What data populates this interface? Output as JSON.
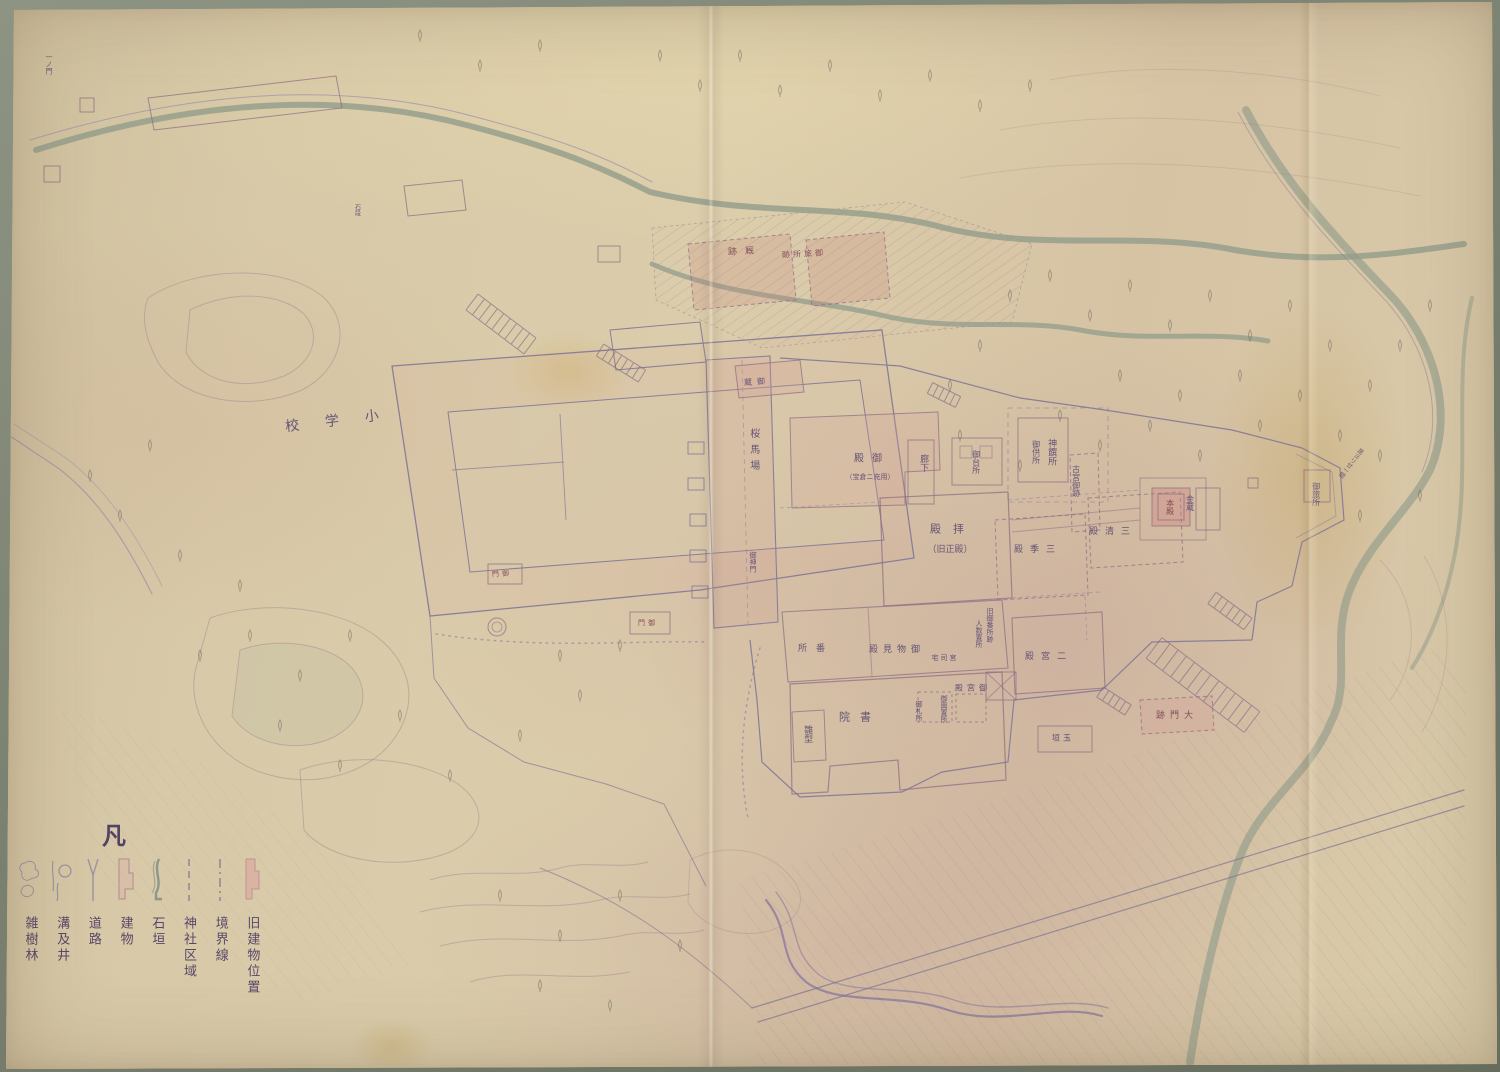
{
  "legend": {
    "title": "凡",
    "items": [
      {
        "label": "旧建物位置",
        "symbol": "old-building-position"
      },
      {
        "label": "境界線",
        "symbol": "boundary-line"
      },
      {
        "label": "神社区域",
        "symbol": "shrine-area"
      },
      {
        "label": "石垣",
        "symbol": "stone-wall"
      },
      {
        "label": "建物",
        "symbol": "building"
      },
      {
        "label": "道路",
        "symbol": "road"
      },
      {
        "label": "溝及井",
        "symbol": "ditch-and-well"
      },
      {
        "label": "雑樹林",
        "symbol": "mixed-forest"
      }
    ]
  },
  "map": {
    "labels": [
      {
        "id": "elementary-school",
        "text": "小学校",
        "x": 345,
        "y": 420,
        "o": "h",
        "size": 14,
        "ls": 26,
        "rot": -7,
        "rtl": true
      },
      {
        "id": "stable-site",
        "text": "厩跡",
        "x": 745,
        "y": 252,
        "o": "h",
        "size": 9,
        "ls": 8,
        "rot": -3,
        "rtl": true,
        "color": "#7a4152"
      },
      {
        "id": "otabisho-site",
        "text": "御旅所跡",
        "x": 804,
        "y": 254,
        "o": "h",
        "size": 8,
        "ls": 3,
        "rot": -3,
        "rtl": true,
        "color": "#7a4152"
      },
      {
        "id": "sakura-baba",
        "text": "桜馬場",
        "x": 753,
        "y": 452,
        "o": "v",
        "size": 10,
        "ls": 6
      },
      {
        "id": "shinmon-note",
        "text": "御神門",
        "x": 753,
        "y": 562,
        "o": "v",
        "size": 7
      },
      {
        "id": "goten",
        "text": "御殿",
        "x": 872,
        "y": 459,
        "o": "h",
        "size": 10,
        "ls": 8,
        "rtl": true
      },
      {
        "id": "goten-sub",
        "text": "（宝倉ニ充用）",
        "x": 870,
        "y": 477,
        "o": "h",
        "size": 7
      },
      {
        "id": "rouka",
        "text": "廊下",
        "x": 923,
        "y": 463,
        "o": "v",
        "size": 9
      },
      {
        "id": "odaidokoro",
        "text": "御台所",
        "x": 976,
        "y": 462,
        "o": "v",
        "size": 8
      },
      {
        "id": "haiden",
        "text": "拝殿",
        "x": 953,
        "y": 530,
        "o": "h",
        "size": 11,
        "ls": 12,
        "rtl": true
      },
      {
        "id": "haiden-sub",
        "text": "（旧正殿）",
        "x": 950,
        "y": 550,
        "o": "h",
        "size": 9
      },
      {
        "id": "shinsensho",
        "text": "神饌所",
        "x": 1051,
        "y": 452,
        "o": "v",
        "size": 9
      },
      {
        "id": "gokusho",
        "text": "御供所",
        "x": 1036,
        "y": 452,
        "o": "v",
        "size": 8
      },
      {
        "id": "old-shrine-site",
        "text": "古宮御跡",
        "x": 1076,
        "y": 481,
        "o": "v",
        "size": 8
      },
      {
        "id": "sankiden",
        "text": "三季殿",
        "x": 1038,
        "y": 550,
        "o": "h",
        "size": 9,
        "ls": 7,
        "rtl": true
      },
      {
        "id": "sanseiden",
        "text": "三清殿",
        "x": 1113,
        "y": 532,
        "o": "h",
        "size": 9,
        "ls": 7,
        "rtl": true
      },
      {
        "id": "honden",
        "text": "本殿",
        "x": 1170,
        "y": 507,
        "o": "v",
        "size": 8,
        "color": "#7a3c4e"
      },
      {
        "id": "kinzo",
        "text": "金蔵",
        "x": 1190,
        "y": 503,
        "o": "v",
        "size": 8
      },
      {
        "id": "bansho",
        "text": "番所",
        "x": 816,
        "y": 649,
        "o": "h",
        "size": 9,
        "ls": 9,
        "rtl": true
      },
      {
        "id": "omonomi-den",
        "text": "御物見殿",
        "x": 897,
        "y": 650,
        "o": "h",
        "size": 9,
        "ls": 5,
        "rtl": true
      },
      {
        "id": "old-bansho-note",
        "text": "旧御番所跡",
        "x": 990,
        "y": 625,
        "o": "v",
        "size": 7
      },
      {
        "id": "ninzu-note",
        "text": "人数置所",
        "x": 979,
        "y": 634,
        "o": "v",
        "size": 7
      },
      {
        "id": "shoin",
        "text": "書院",
        "x": 860,
        "y": 718,
        "o": "h",
        "size": 11,
        "ls": 10,
        "rtl": true
      },
      {
        "id": "hinagata",
        "text": "雛型",
        "x": 807,
        "y": 734,
        "o": "v",
        "size": 9
      },
      {
        "id": "ofudasho",
        "text": "御札所",
        "x": 919,
        "y": 711,
        "o": "v",
        "size": 7
      },
      {
        "id": "mikoshi-okisho",
        "text": "御輿置所",
        "x": 944,
        "y": 709,
        "o": "v",
        "size": 7
      },
      {
        "id": "miyadono",
        "text": "御宮殿",
        "x": 973,
        "y": 688,
        "o": "h",
        "size": 8,
        "ls": 4,
        "rtl": true
      },
      {
        "id": "guji-taku",
        "text": "宮司宅",
        "x": 945,
        "y": 658,
        "o": "h",
        "size": 7,
        "ls": 2,
        "rtl": true
      },
      {
        "id": "ninomiya-den",
        "text": "二宮殿",
        "x": 1049,
        "y": 657,
        "o": "h",
        "size": 9,
        "ls": 7,
        "rtl": true
      },
      {
        "id": "daimon-site",
        "text": "大門跡",
        "x": 1177,
        "y": 716,
        "o": "h",
        "size": 9,
        "ls": 5,
        "rtl": true,
        "color": "#7a4152"
      },
      {
        "id": "tamagaki",
        "text": "玉垣",
        "x": 1063,
        "y": 738,
        "o": "h",
        "size": 8,
        "ls": 3,
        "rtl": true
      },
      {
        "id": "okura",
        "text": "御蔵",
        "x": 757,
        "y": 382,
        "o": "h",
        "size": 8,
        "ls": 5,
        "rot": -4,
        "rtl": true
      },
      {
        "id": "gomon-west",
        "text": "御門",
        "x": 502,
        "y": 574,
        "o": "h",
        "size": 7,
        "ls": 3,
        "rot": -4,
        "rtl": true,
        "color": "#7a3c4e"
      },
      {
        "id": "gomon-south",
        "text": "御門",
        "x": 648,
        "y": 623,
        "o": "h",
        "size": 7,
        "ls": 3,
        "rtl": true,
        "color": "#7a3c4e"
      },
      {
        "id": "otabisho-east",
        "text": "御旅所",
        "x": 1316,
        "y": 494,
        "o": "v",
        "size": 8
      },
      {
        "id": "distance-note",
        "text": "是ヨリ廿一間",
        "x": 1350,
        "y": 462,
        "o": "v",
        "size": 6,
        "rot": 38
      },
      {
        "id": "ichi-no-mon",
        "text": "一ノ門",
        "x": 49,
        "y": 64,
        "o": "v",
        "size": 7
      },
      {
        "id": "sekidan-note",
        "text": "石段",
        "x": 356,
        "y": 210,
        "o": "v",
        "size": 6
      }
    ]
  },
  "colors": {
    "paper": "#d6c6a5",
    "paper_pink": "#d0b5ac",
    "backing": "#7c8272",
    "ink_purple": "#57466f",
    "water_green": "#929c8b",
    "building_pink": "#d9afa4"
  }
}
